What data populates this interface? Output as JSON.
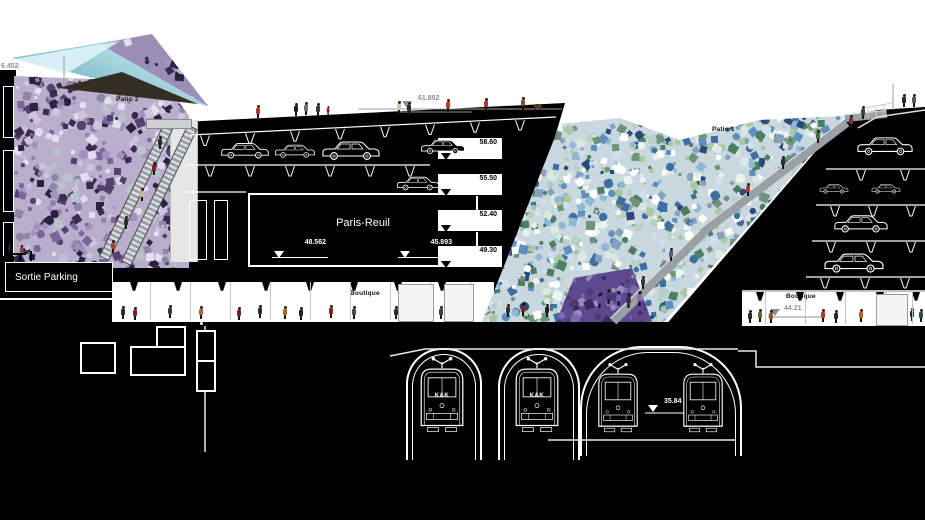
{
  "drawing": {
    "title": "Architectural longitudinal section",
    "labels": {
      "patio2": "Patio 2",
      "patio1": "Patio 1",
      "sortie_parking": "Sortie Parking",
      "station": "Paris-Reuil",
      "boutique_left": "Boutique",
      "boutique_right": "Boutique",
      "tram_marking": "K&K"
    },
    "elevations": {
      "top_deck": "61.892",
      "p1": "58.60",
      "p2": "55.50",
      "p3": "52.40",
      "p4": "49.30",
      "hall_left": "48.562",
      "hall_right": "45.893",
      "street_right": "44.21",
      "tunnel": "35.84",
      "canopy": "6.452"
    },
    "colors": {
      "poche": "#000000",
      "paper": "#ffffff",
      "marker_grey": "#8f8f8f",
      "ramp_grey": "#9aa0a6",
      "glass_teal": "#8ec7d2",
      "mosaic_purple": [
        "#cfc3dd",
        "#a391bf",
        "#7b659c",
        "#56406f",
        "#e4def0",
        "#3a2b50",
        "#b8c4cc",
        "#2b2140",
        "#8d86a8"
      ],
      "mosaic_green_blue": [
        "#ffffff",
        "#dce8e2",
        "#b5d0c5",
        "#8fb8d6",
        "#5f8fc0",
        "#3f6ea3",
        "#87a0bd",
        "#a8c8a0",
        "#6f9478",
        "#eef3ee",
        "#2c4a77",
        "#cfe0ef",
        "#4a7f62"
      ],
      "mosaic_violet": [
        "#7d6bb0",
        "#5d4a8e",
        "#4a3a70",
        "#9a8ac0",
        "#3a2b5e"
      ]
    }
  }
}
